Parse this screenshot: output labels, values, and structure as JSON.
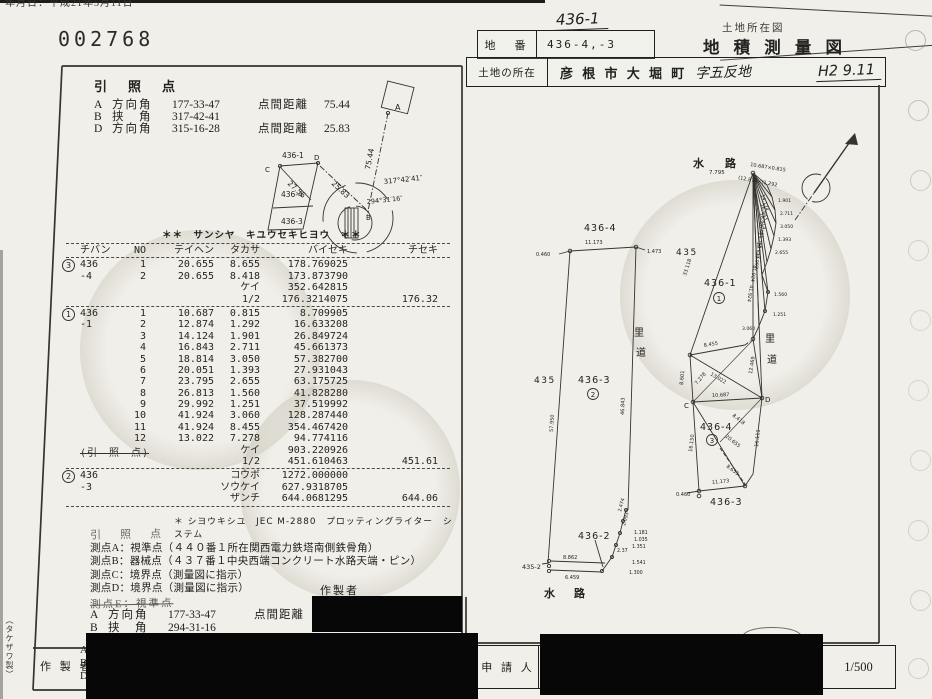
{
  "page": {
    "doc_number": "002768",
    "top_edge_text": "年月日：平成21年5月11日",
    "maker_mark": "（タケザワ製）"
  },
  "header": {
    "hand_parcel": "436-1",
    "parcel_label": "地　番",
    "parcel_value": "436-4,-3",
    "struck_title": "土地所在図",
    "title": "地 積 測 量 図",
    "location_label": "土地の所在",
    "location_value": "彦 根 市 大 堀 町",
    "location_hand": "字五反地",
    "date_hand": "H2 9.11"
  },
  "ref_top": {
    "heading": "引　照　点",
    "rows": [
      {
        "pt": "A",
        "kind": "方向角",
        "angle": "177-33-47",
        "dlabel": "点間距離",
        "dist": "75.44"
      },
      {
        "pt": "B",
        "kind": "挟　角",
        "angle": "317-42-41",
        "dlabel": "",
        "dist": ""
      },
      {
        "pt": "D",
        "kind": "方向角",
        "angle": "315-16-28",
        "dlabel": "点間距離",
        "dist": "25.83"
      }
    ]
  },
  "inset": {
    "pt_a": "A",
    "pt_b": "B",
    "pt_c": "C",
    "pt_d": "D",
    "p436_1": "436-1",
    "p436_4": "436-4",
    "p436_3": "436-3",
    "d27_56": "27.56",
    "d25_83": "25.83",
    "d75_44": "75.44",
    "ang1": "317°42′41″",
    "ang2": "294°31′16″"
  },
  "table": {
    "title": "＊＊　サンシヤ　キユウセキヒヨウ　＊＊",
    "headers": [
      "チバン",
      "NO",
      "テイヘン",
      "タカサ",
      "バイセキ",
      "チセキ"
    ],
    "footer": "＊ シヨウキシユ　JEC M-2880　プロッティングライター　システム",
    "sections": [
      {
        "mark": "3",
        "rows": [
          [
            "436",
            "1",
            "20.655",
            "8.655",
            "178.769025",
            ""
          ],
          [
            "-4",
            "2",
            "20.655",
            "8.418",
            "173.873790",
            ""
          ],
          [
            "",
            "",
            "",
            "ケイ",
            "352.642815",
            ""
          ],
          [
            "",
            "",
            "",
            "1/2",
            "176.3214075",
            "176.32"
          ]
        ]
      },
      {
        "mark": "1",
        "struck_note": "(引　照　点)",
        "rows": [
          [
            "436",
            "1",
            "10.687",
            "0.815",
            "8.709905",
            ""
          ],
          [
            "-1",
            "2",
            "12.874",
            "1.292",
            "16.633208",
            ""
          ],
          [
            "",
            "3",
            "14.124",
            "1.901",
            "26.849724",
            ""
          ],
          [
            "",
            "4",
            "16.843",
            "2.711",
            "45.661373",
            ""
          ],
          [
            "",
            "5",
            "18.814",
            "3.050",
            "57.382700",
            ""
          ],
          [
            "",
            "6",
            "20.051",
            "1.393",
            "27.931043",
            ""
          ],
          [
            "",
            "7",
            "23.795",
            "2.655",
            "63.175725",
            ""
          ],
          [
            "",
            "8",
            "26.813",
            "1.560",
            "41.828280",
            ""
          ],
          [
            "",
            "9",
            "29.992",
            "1.251",
            "37.519992",
            ""
          ],
          [
            "",
            "10",
            "41.924",
            "3.060",
            "128.287440",
            ""
          ],
          [
            "",
            "11",
            "41.924",
            "8.455",
            "354.467420",
            ""
          ],
          [
            "",
            "12",
            "13.022",
            "7.278",
            "94.774116",
            ""
          ],
          [
            "",
            "",
            "",
            "ケイ",
            "903.220926",
            ""
          ],
          [
            "",
            "",
            "",
            "1/2",
            "451.610463",
            "451.61"
          ]
        ]
      },
      {
        "mark": "2",
        "rows": [
          [
            "436",
            "",
            "",
            "コウボ",
            "1272.000000",
            ""
          ],
          [
            "-3",
            "",
            "",
            "ソウケイ",
            "627.9318705",
            ""
          ],
          [
            "",
            "",
            "",
            "ザンチ",
            "644.0681295",
            "644.06"
          ]
        ]
      }
    ]
  },
  "notes": {
    "heading": "引　照　点",
    "lines": [
      "測点A：視準点（４４０番１所在関西電力鉄塔南側鉄骨角）",
      "測点B：器械点（４３７番１中央西端コンクリート水路天端・ピン）",
      "測点C：境界点（測量図に指示）",
      "測点D：境界点（測量図に指示）"
    ],
    "struck_line": "測点E：視準点",
    "rows": [
      {
        "pt": "A",
        "kind": "方向角",
        "angle": "177-33-47",
        "dlabel": "点間距離",
        "dist": "75.44"
      },
      {
        "pt": "B",
        "kind": "挟　角",
        "angle": "294-31-16",
        "dlabel": "",
        "dist": ""
      },
      {
        "pt": "C",
        "kind": "方向角",
        "angle": "292-05-03",
        "dlabel": "点間距離",
        "dist": "27.56"
      }
    ],
    "maker_label": "作製者"
  },
  "footer": {
    "maker_label": "作 製 者",
    "maker_points": [
      "A",
      "B",
      "D"
    ],
    "applicant_label": "申 請 人",
    "scale": "1/500"
  },
  "map_center": {
    "parcel_top": "436-4",
    "len_top": "11.173",
    "tick_left": "0.460",
    "tick_right": "1.473",
    "parcel_right": "435",
    "len_left": "57.950",
    "len_right": "46.843",
    "road_1": "里",
    "road_2": "道",
    "parcel_left": "435",
    "parcel_main": "436-3",
    "circle": "2",
    "parcel_436_2": "436-2",
    "parcel_435_2": "435-2",
    "len_8862": "8.862",
    "len_6459": "6.459",
    "waterway": "水　路",
    "c1300": "1.300",
    "c1541": "1.541",
    "c237": "2.37",
    "c1351": "1.351",
    "c1035": "1.035",
    "c1181": "1.181",
    "c2093": "2.093",
    "c2474": "2.474"
  },
  "map_right": {
    "waterway": "水　路",
    "apex": "7.795",
    "fan1": "10.687×0.815",
    "fan2": "(12.874×(1.292",
    "t1901": "1.901",
    "t2711": "2.711",
    "t3050": "3.050",
    "t1393": "1.393",
    "t2655": "2.655",
    "r14124": "14.124",
    "r16843": "16.843",
    "r18814": "18.814",
    "r20051": "20.051",
    "r23795": "23.795",
    "r26813": "26.813",
    "r29992": "29.992",
    "r41924a": "41.924",
    "r41924b": "41.924",
    "t1560": "1.560",
    "t1251": "1.251",
    "t3060": "3.060",
    "len33118": "33.118",
    "parcel_436_1": "436-1",
    "circle1": "1",
    "road_1": "里",
    "road_2": "道",
    "l8455": "8.455",
    "l13022": "13.022",
    "l7278": "7.278",
    "l8601": "8.601",
    "l12469": "12.469",
    "l10687": "10.687",
    "pt_c": "C",
    "pt_d": "D",
    "parcel_436_4": "436-4",
    "circle3": "3",
    "l8418": "8.418",
    "l20655": "20.655",
    "l16150": "16.150",
    "l16111": "16.111",
    "l8655": "8.655",
    "l11173": "11.173",
    "tick0460": "0.460",
    "parcel_436_3": "436-3"
  }
}
